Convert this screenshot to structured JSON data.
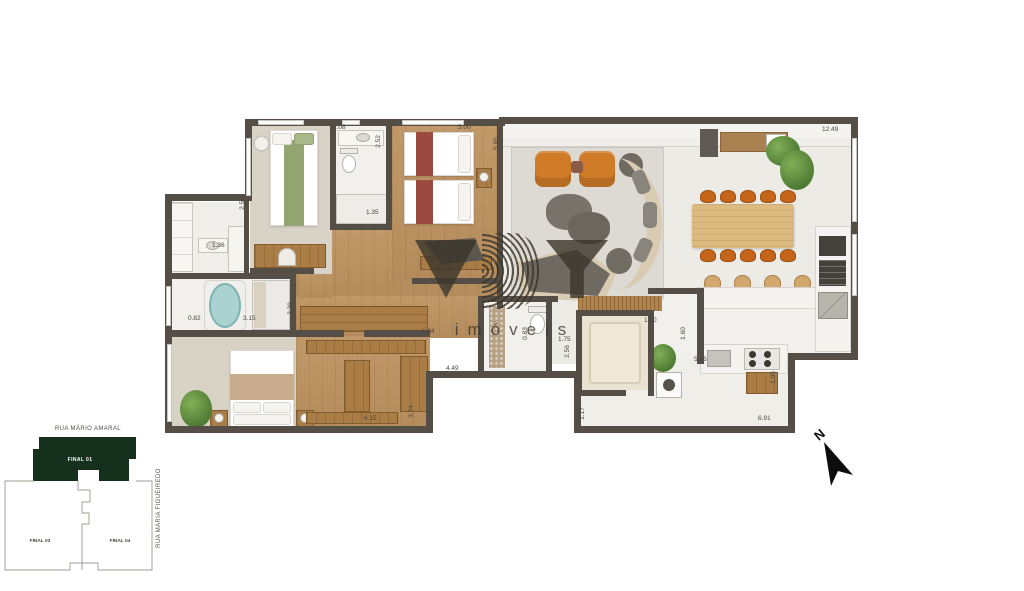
{
  "figure": {
    "description": "apartment floor plan top-down render"
  },
  "watermark": {
    "letter_v": "V",
    "letter_b": "B",
    "letter_y": "Y",
    "wordmark": "imóveis",
    "color": "#3a342b"
  },
  "north_arrow": {
    "label": "N"
  },
  "site_plan": {
    "street_top": "RUA MÁRIO AMARAL",
    "street_right": "RUA MARIA FIGUEIREDO",
    "highlighted_unit": "FINAL 01",
    "unit_bottom_left": "FINAL 03",
    "unit_bottom_right": "FINAL 04",
    "highlight_color": "#16301e"
  },
  "plan": {
    "wall_color": "#544e46",
    "dimensions": [
      "2.08",
      "3.00",
      "12.49",
      "2.52",
      "5.85",
      "2.53",
      "1.35",
      "1.36",
      "0.82",
      "3.15",
      "2.29",
      "1.84",
      "0.83",
      "1.75",
      "2.56",
      "1.50",
      "1.60",
      "5.06",
      "4.49",
      "6.15",
      "3.74",
      "1.17",
      "1.05",
      "6.91"
    ]
  }
}
